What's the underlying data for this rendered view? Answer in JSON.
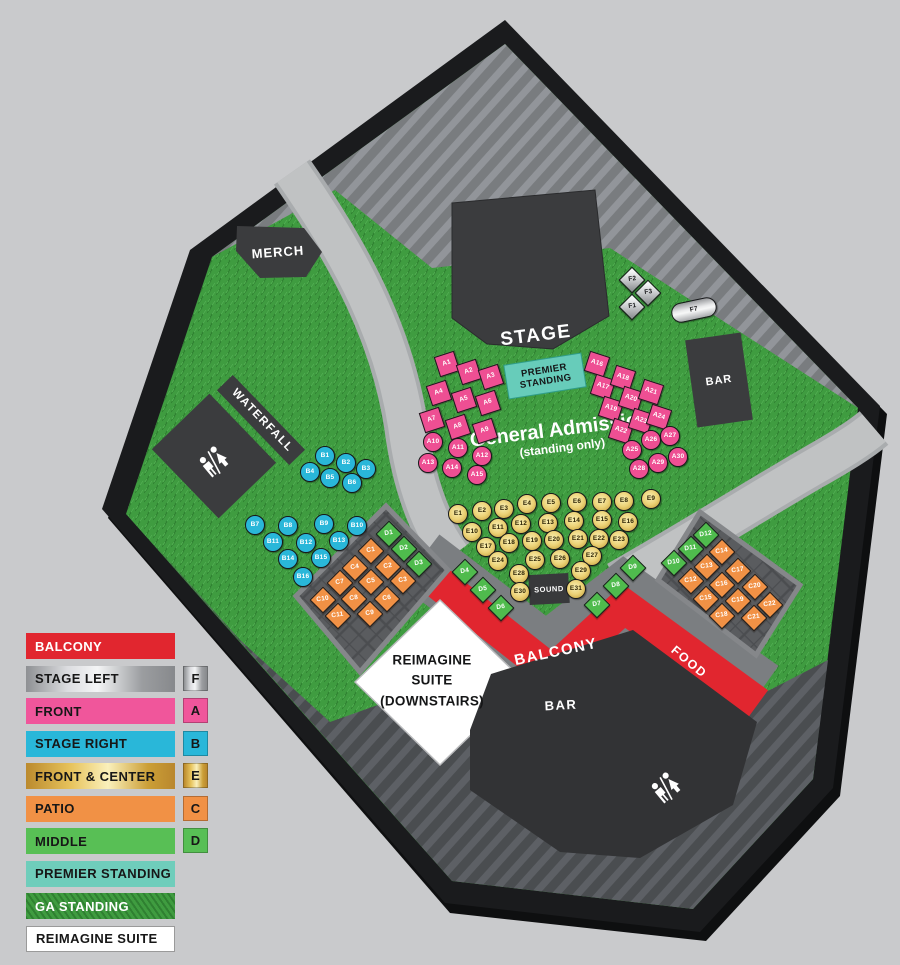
{
  "page_bg": "#c9cacc",
  "map": {
    "areas": {
      "stage": "STAGE",
      "merch": "MERCH",
      "waterfall": "WATERFALL",
      "bar_top": "BAR",
      "bar_bottom": "BAR",
      "balcony": "BALCONY",
      "food": "FOOD",
      "sound": "SOUND",
      "premier_line1": "PREMIER",
      "premier_line2": "STANDING",
      "ga_line1": "General Admission",
      "ga_line2": "(standing only)",
      "reimagine_line1": "REIMAGINE",
      "reimagine_line2": "SUITE",
      "reimagine_line3": "(DOWNSTAIRS)"
    },
    "icons": [
      "restroom-icon-waterfall",
      "restroom-icon-bar"
    ],
    "colors": {
      "balcony_red": "#e1262f",
      "front_pink": "#ee4f93",
      "stage_right_blue": "#29b7d9",
      "patio_orange": "#f19145",
      "middle_green": "#4fbb4d",
      "front_center_gold": "#e0bd55",
      "stage_left_silver": "#c7c8ca",
      "premier_teal": "#67ccba",
      "ga_grass_green": "#3f9c40",
      "suite_white": "#ffffff"
    },
    "seat_groups": [
      {
        "key": "A",
        "section": "FRONT",
        "color": "#ee4f93",
        "seats": [
          [
            "A1",
            447,
            364,
            "q",
            -18
          ],
          [
            "A2",
            469,
            372,
            "q",
            -18
          ],
          [
            "A3",
            491,
            377,
            "q",
            -18
          ],
          [
            "A4",
            439,
            393,
            "q",
            -18
          ],
          [
            "A5",
            464,
            400,
            "q",
            -18
          ],
          [
            "A6",
            488,
            403,
            "q",
            -18
          ],
          [
            "A7",
            432,
            420,
            "q",
            -18
          ],
          [
            "A8",
            458,
            427,
            "q",
            -18
          ],
          [
            "A9",
            485,
            431,
            "q",
            -18
          ],
          [
            "A10",
            433,
            442,
            "c",
            0
          ],
          [
            "A11",
            458,
            448,
            "c",
            0
          ],
          [
            "A12",
            482,
            456,
            "c",
            0
          ],
          [
            "A13",
            428,
            463,
            "c",
            0
          ],
          [
            "A14",
            452,
            468,
            "c",
            0
          ],
          [
            "A15",
            477,
            475,
            "c",
            0
          ],
          [
            "A16",
            597,
            364,
            "q",
            18
          ],
          [
            "A17",
            603,
            387,
            "q",
            18
          ],
          [
            "A18",
            623,
            378,
            "q",
            18
          ],
          [
            "A19",
            611,
            409,
            "q",
            18
          ],
          [
            "A20",
            631,
            399,
            "q",
            18
          ],
          [
            "A21",
            651,
            392,
            "q",
            18
          ],
          [
            "A22",
            621,
            431,
            "q",
            18
          ],
          [
            "A23",
            641,
            421,
            "q",
            18
          ],
          [
            "A24",
            659,
            417,
            "q",
            18
          ],
          [
            "A25",
            632,
            450,
            "c",
            0
          ],
          [
            "A26",
            651,
            440,
            "c",
            0
          ],
          [
            "A27",
            670,
            436,
            "c",
            0
          ],
          [
            "A28",
            639,
            469,
            "c",
            0
          ],
          [
            "A29",
            658,
            463,
            "c",
            0
          ],
          [
            "A30",
            678,
            457,
            "c",
            0
          ]
        ]
      },
      {
        "key": "B",
        "section": "STAGE RIGHT",
        "color": "#29b7d9",
        "seats": [
          [
            "B1",
            325,
            456,
            "c",
            0
          ],
          [
            "B2",
            346,
            463,
            "c",
            0
          ],
          [
            "B3",
            366,
            469,
            "c",
            0
          ],
          [
            "B4",
            310,
            472,
            "c",
            0
          ],
          [
            "B5",
            330,
            478,
            "c",
            0
          ],
          [
            "B6",
            352,
            483,
            "c",
            0
          ],
          [
            "B7",
            255,
            525,
            "c",
            0
          ],
          [
            "B8",
            288,
            526,
            "c",
            0
          ],
          [
            "B9",
            324,
            524,
            "c",
            0
          ],
          [
            "B10",
            357,
            526,
            "c",
            0
          ],
          [
            "B11",
            273,
            542,
            "c",
            0
          ],
          [
            "B12",
            306,
            543,
            "c",
            0
          ],
          [
            "B13",
            339,
            541,
            "c",
            0
          ],
          [
            "B14",
            288,
            559,
            "c",
            0
          ],
          [
            "B15",
            321,
            558,
            "c",
            0
          ],
          [
            "B16",
            303,
            577,
            "c",
            0
          ]
        ]
      },
      {
        "key": "C",
        "section": "PATIO",
        "color": "#f19145",
        "seats": [
          [
            "C1",
            371,
            551,
            "d",
            45
          ],
          [
            "C2",
            388,
            567,
            "d",
            45
          ],
          [
            "C3",
            403,
            581,
            "d",
            45
          ],
          [
            "C4",
            355,
            568,
            "d",
            45
          ],
          [
            "C5",
            371,
            582,
            "d",
            45
          ],
          [
            "C6",
            387,
            599,
            "d",
            45
          ],
          [
            "C7",
            340,
            583,
            "d",
            45
          ],
          [
            "C8",
            354,
            599,
            "d",
            45
          ],
          [
            "C9",
            370,
            614,
            "d",
            45
          ],
          [
            "C10",
            323,
            600,
            "d",
            45
          ],
          [
            "C11",
            338,
            616,
            "d",
            45
          ],
          [
            "C12",
            691,
            581,
            "d",
            45
          ],
          [
            "C13",
            707,
            567,
            "d",
            45
          ],
          [
            "C14",
            722,
            552,
            "d",
            45
          ],
          [
            "C15",
            706,
            599,
            "d",
            45
          ],
          [
            "C16",
            722,
            585,
            "d",
            45
          ],
          [
            "C17",
            738,
            571,
            "d",
            45
          ],
          [
            "C18",
            722,
            616,
            "d",
            45
          ],
          [
            "C19",
            738,
            601,
            "d",
            45
          ],
          [
            "C20",
            755,
            587,
            "d",
            45
          ],
          [
            "C21",
            754,
            618,
            "d",
            45
          ],
          [
            "C22",
            770,
            605,
            "d",
            45
          ]
        ]
      },
      {
        "key": "D",
        "section": "MIDDLE",
        "color": "#4fbb4d",
        "seats": [
          [
            "D1",
            389,
            534,
            "d",
            45
          ],
          [
            "D2",
            404,
            549,
            "d",
            45
          ],
          [
            "D3",
            419,
            564,
            "d",
            45
          ],
          [
            "D4",
            465,
            572,
            "d",
            45
          ],
          [
            "D5",
            483,
            590,
            "d",
            45
          ],
          [
            "D6",
            501,
            608,
            "d",
            45
          ],
          [
            "D7",
            597,
            605,
            "d",
            45
          ],
          [
            "D8",
            616,
            586,
            "d",
            45
          ],
          [
            "D9",
            633,
            568,
            "d",
            45
          ],
          [
            "D10",
            674,
            563,
            "d",
            45
          ],
          [
            "D11",
            691,
            549,
            "d",
            45
          ],
          [
            "D12",
            706,
            535,
            "d",
            45
          ]
        ]
      },
      {
        "key": "E",
        "section": "FRONT & CENTER",
        "color": "#e0bd55",
        "seats": [
          [
            "E1",
            458,
            514,
            "c",
            0
          ],
          [
            "E2",
            482,
            511,
            "c",
            0
          ],
          [
            "E3",
            504,
            509,
            "c",
            0
          ],
          [
            "E4",
            527,
            504,
            "c",
            0
          ],
          [
            "E5",
            551,
            503,
            "c",
            0
          ],
          [
            "E6",
            577,
            502,
            "c",
            0
          ],
          [
            "E7",
            602,
            502,
            "c",
            0
          ],
          [
            "E8",
            624,
            501,
            "c",
            0
          ],
          [
            "E9",
            651,
            499,
            "c",
            0
          ],
          [
            "E10",
            472,
            532,
            "c",
            0
          ],
          [
            "E11",
            498,
            528,
            "c",
            0
          ],
          [
            "E12",
            521,
            524,
            "c",
            0
          ],
          [
            "E13",
            548,
            523,
            "c",
            0
          ],
          [
            "E14",
            574,
            521,
            "c",
            0
          ],
          [
            "E15",
            602,
            520,
            "c",
            0
          ],
          [
            "E16",
            628,
            522,
            "c",
            0
          ],
          [
            "E17",
            486,
            547,
            "c",
            0
          ],
          [
            "E18",
            509,
            543,
            "c",
            0
          ],
          [
            "E19",
            532,
            541,
            "c",
            0
          ],
          [
            "E20",
            554,
            540,
            "c",
            0
          ],
          [
            "E21",
            578,
            539,
            "c",
            0
          ],
          [
            "E22",
            599,
            539,
            "c",
            0
          ],
          [
            "E23",
            619,
            540,
            "c",
            0
          ],
          [
            "E24",
            498,
            561,
            "c",
            0
          ],
          [
            "E25",
            535,
            560,
            "c",
            0
          ],
          [
            "E26",
            560,
            559,
            "c",
            0
          ],
          [
            "E27",
            592,
            556,
            "c",
            0
          ],
          [
            "E28",
            519,
            574,
            "c",
            0
          ],
          [
            "E29",
            581,
            571,
            "c",
            0
          ],
          [
            "E30",
            520,
            592,
            "c",
            0
          ],
          [
            "E31",
            576,
            589,
            "c",
            0
          ]
        ]
      },
      {
        "key": "F",
        "section": "STAGE LEFT",
        "color": "#c7c8ca",
        "seats": [
          [
            "F2",
            632,
            280,
            "d",
            45
          ],
          [
            "F3",
            648,
            293,
            "d",
            45
          ],
          [
            "F1",
            632,
            307,
            "d",
            45
          ],
          [
            "F7",
            694,
            310,
            "p",
            -12
          ]
        ]
      }
    ]
  },
  "legend": {
    "items": [
      {
        "label": "BALCONY",
        "swatch": "red",
        "badge": "",
        "light_text": true
      },
      {
        "label": "STAGE LEFT",
        "swatch": "silver",
        "badge": "F",
        "light_text": false
      },
      {
        "label": "FRONT",
        "swatch": "pink",
        "badge": "A",
        "light_text": false
      },
      {
        "label": "STAGE RIGHT",
        "swatch": "blue",
        "badge": "B",
        "light_text": false
      },
      {
        "label": "FRONT & CENTER",
        "swatch": "gold",
        "badge": "E",
        "light_text": false
      },
      {
        "label": "PATIO",
        "swatch": "orange",
        "badge": "C",
        "light_text": false
      },
      {
        "label": "MIDDLE",
        "swatch": "green",
        "badge": "D",
        "light_text": false
      },
      {
        "label": "PREMIER STANDING",
        "swatch": "teal",
        "badge": "",
        "light_text": false
      },
      {
        "label": "GA STANDING",
        "swatch": "grass",
        "badge": "",
        "light_text": true
      },
      {
        "label": "REIMAGINE SUITE",
        "swatch": "white",
        "badge": "",
        "light_text": false
      }
    ]
  }
}
